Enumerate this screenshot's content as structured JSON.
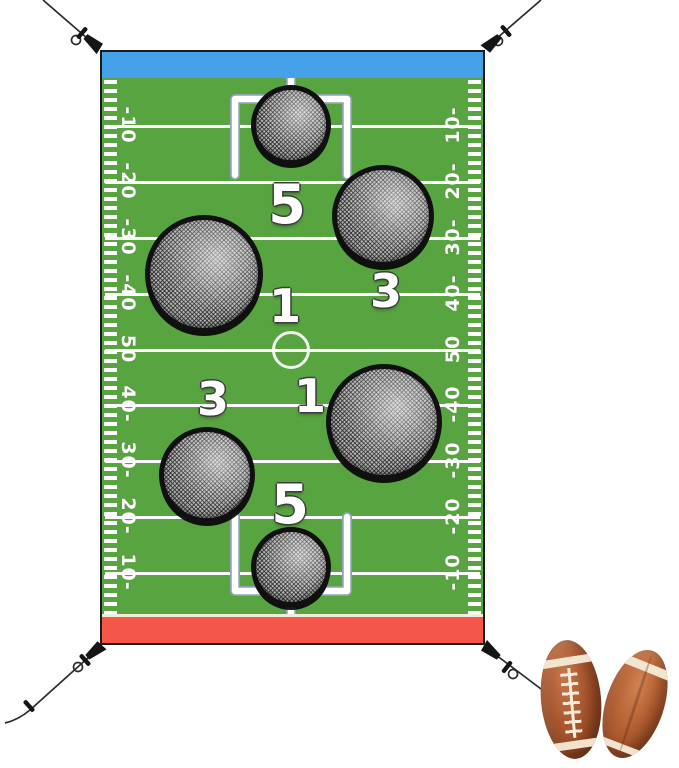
{
  "banner": {
    "description": "football toss game banner",
    "colors": {
      "field_green": "#58a441",
      "endzone_blue": "#45a2e8",
      "endzone_red": "#f4564a",
      "line_white": "#ffffff",
      "goal_line_cream": "#f2edd8",
      "mesh_gray": "#b3b3b3",
      "hole_ring_black": "#101010",
      "rope_black": "#2b2b2b",
      "football_brown": "#a5532c",
      "lace_cream": "#f6ecd9"
    },
    "yard_labels_left": [
      "-10",
      "-20",
      "-30",
      "-40",
      "50",
      "40-",
      "30-",
      "20-",
      "10-"
    ],
    "yard_labels_right": [
      "10-",
      "20-",
      "30-",
      "40-",
      "50",
      "-40",
      "-30",
      "-20",
      "-10"
    ],
    "holes": [
      {
        "position": "top-center-small",
        "score": "5"
      },
      {
        "position": "upper-right-large",
        "score": "3"
      },
      {
        "position": "mid-left-large",
        "score": "1"
      },
      {
        "position": "mid-right-large",
        "score": "1"
      },
      {
        "position": "lower-left-medium",
        "score": "3"
      },
      {
        "position": "bottom-center-small",
        "score": "5"
      }
    ]
  },
  "props": {
    "footballs": {
      "count": 2
    }
  }
}
